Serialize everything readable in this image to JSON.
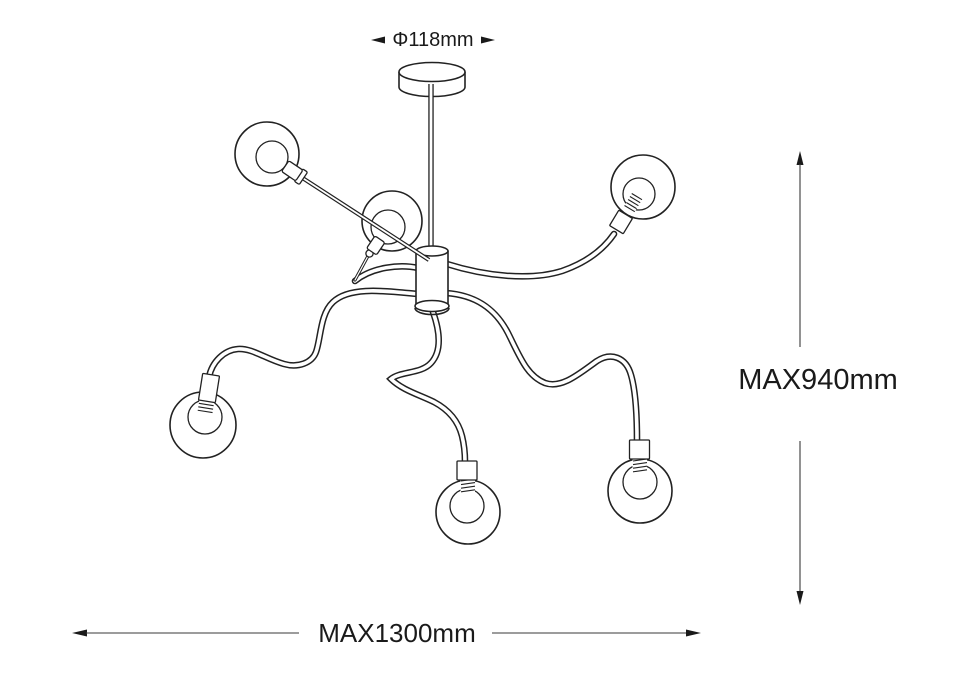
{
  "page": {
    "background_color": "#ffffff",
    "line_color": "#222222"
  },
  "drawing": {
    "subject": "six-arm chandelier technical line drawing",
    "bulb_count": 6
  },
  "dimension_labels": {
    "canopy_diameter": "Φ118mm",
    "max_height": "MAX940mm",
    "max_width": "MAX1300mm"
  }
}
